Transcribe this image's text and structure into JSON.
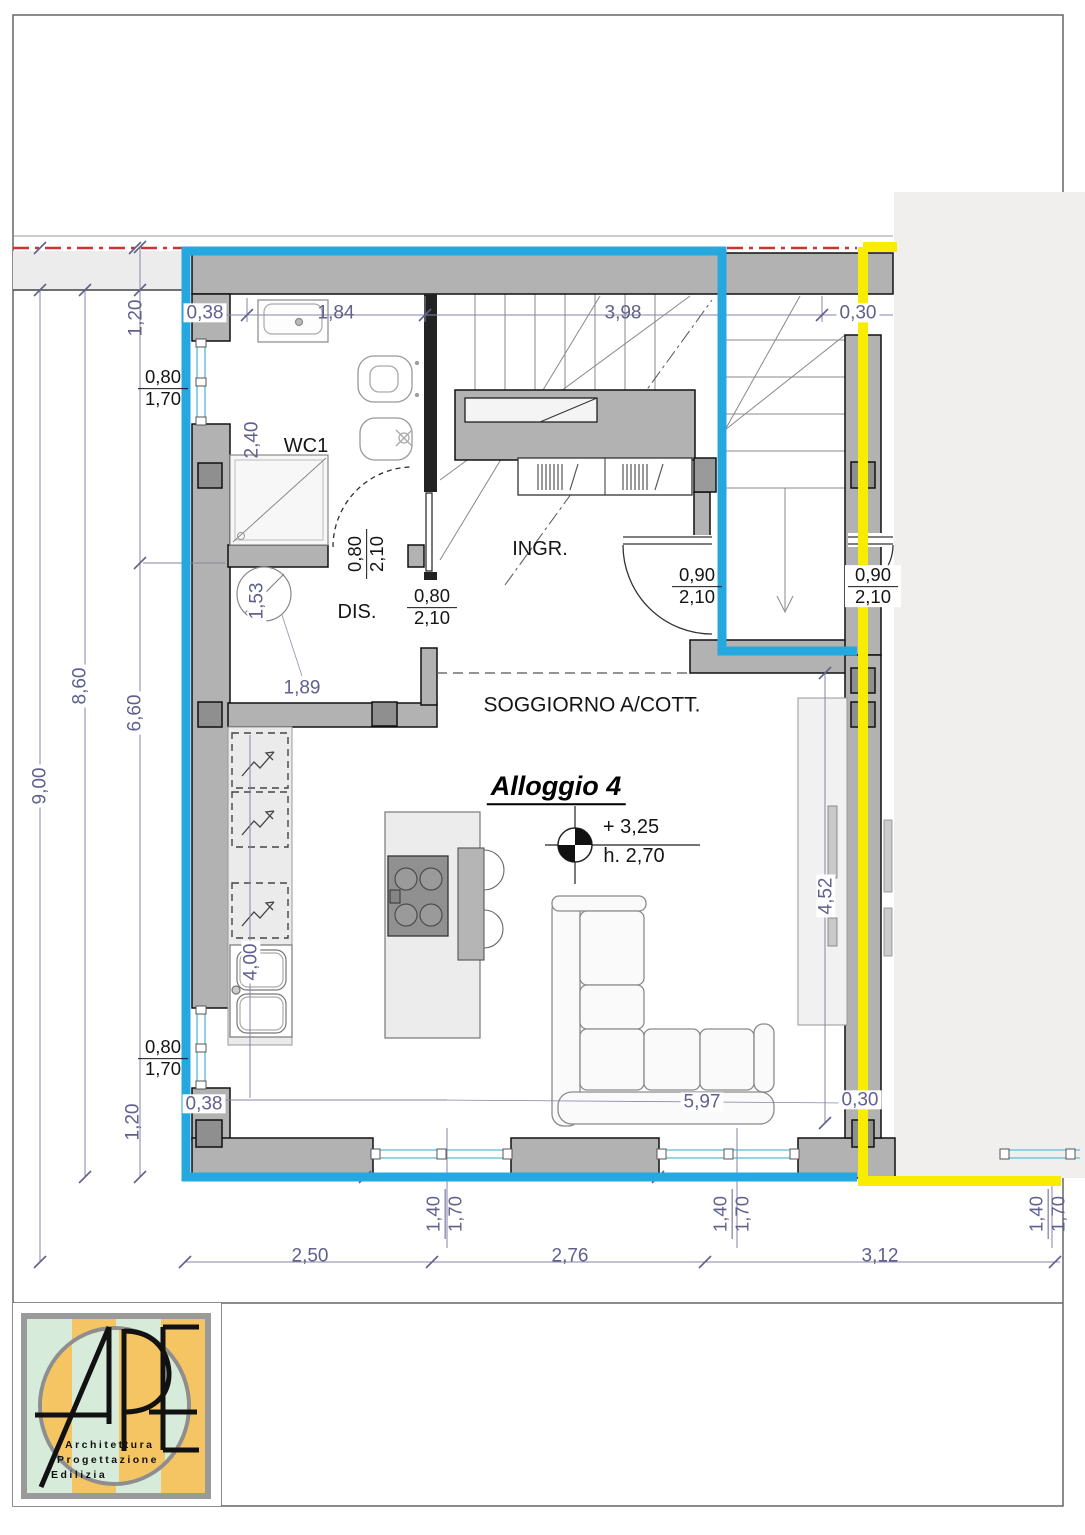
{
  "drawing": {
    "apartment_title": "Alloggio 4",
    "elevation_level": "+ 3,25",
    "elevation_height": "h. 2,70"
  },
  "colors": {
    "blue": "#25a8e0",
    "yellow": "#f8ec00",
    "red": "#cc3333",
    "wall": "#b2b2b2",
    "panel": "#f0efee",
    "strip": "#ececec",
    "counter": "#ebebeb",
    "dimColor": "#60608e",
    "window": "#74c6de",
    "logoGreen": "#d6ebd9",
    "logoOrange": "#f6c563"
  },
  "labels": [
    {
      "kind": "dim",
      "text": "0,38",
      "x": 205,
      "y": 313,
      "bg": 1
    },
    {
      "kind": "dim",
      "text": "1,84",
      "x": 336,
      "y": 313
    },
    {
      "kind": "dim",
      "text": "3,98",
      "x": 623,
      "y": 313
    },
    {
      "kind": "dim",
      "text": "0,30",
      "x": 858,
      "y": 313,
      "bg": 1
    },
    {
      "kind": "dim",
      "text": "1,20",
      "x": 136,
      "y": 318,
      "rot": -90
    },
    {
      "kind": "dim",
      "text": "2,40",
      "x": 252,
      "y": 440,
      "rot": -90
    },
    {
      "kind": "dim",
      "text": "1,53",
      "x": 257,
      "y": 601,
      "rot": -90,
      "bg": 1
    },
    {
      "kind": "dim",
      "text": "1,89",
      "x": 302,
      "y": 688,
      "bg": 1
    },
    {
      "kind": "dim",
      "text": "6,60",
      "x": 135,
      "y": 713,
      "rot": -90,
      "bg": 1
    },
    {
      "kind": "dim",
      "text": "8,60",
      "x": 80,
      "y": 686,
      "rot": -90,
      "bg": 1
    },
    {
      "kind": "dim",
      "text": "9,00",
      "x": 40,
      "y": 786,
      "rot": -90,
      "bg": 1
    },
    {
      "kind": "dim",
      "text": "4,00",
      "x": 251,
      "y": 962,
      "rot": -90,
      "bg": 1
    },
    {
      "kind": "dim",
      "text": "1,20",
      "x": 133,
      "y": 1122,
      "rot": -90
    },
    {
      "kind": "dim",
      "text": "0,38",
      "x": 204,
      "y": 1104,
      "bg": 1
    },
    {
      "kind": "dim",
      "text": "5,97",
      "x": 702,
      "y": 1102,
      "bg": 1
    },
    {
      "kind": "dim",
      "text": "0,30",
      "x": 860,
      "y": 1100,
      "bg": 1
    },
    {
      "kind": "dim",
      "text": "4,52",
      "x": 826,
      "y": 896,
      "rot": -90,
      "bg": 1
    },
    {
      "kind": "dim",
      "text": "2,50",
      "x": 310,
      "y": 1256
    },
    {
      "kind": "dim",
      "text": "2,76",
      "x": 570,
      "y": 1256
    },
    {
      "kind": "dim",
      "text": "3,12",
      "x": 880,
      "y": 1256
    },
    {
      "kind": "room",
      "text": "WC1",
      "x": 306,
      "y": 446,
      "name": "room-label-wc1"
    },
    {
      "kind": "room",
      "text": "DIS.",
      "x": 357,
      "y": 612,
      "name": "room-label-dis"
    },
    {
      "kind": "room",
      "text": "INGR.",
      "x": 540,
      "y": 549,
      "name": "room-label-ingresso"
    },
    {
      "kind": "room",
      "text": "SOGGIORNO A/COTT.",
      "x": 592,
      "y": 705,
      "size": 21,
      "name": "room-label-soggiorno"
    },
    {
      "kind": "room",
      "text": "+ 3,25",
      "x": 631,
      "y": 827,
      "name": "elevation-level"
    },
    {
      "kind": "room",
      "text": "h. 2,70",
      "x": 634,
      "y": 856,
      "name": "elevation-height"
    },
    {
      "kind": "title",
      "text": "Alloggio 4",
      "x": 556,
      "y": 789,
      "name": "apartment-title"
    },
    {
      "kind": "frac",
      "top": "0,80",
      "bot": "1,70",
      "x": 163,
      "y": 388,
      "color": "room"
    },
    {
      "kind": "frac",
      "top": "0,80",
      "bot": "1,70",
      "x": 163,
      "y": 1058,
      "color": "room"
    },
    {
      "kind": "frac",
      "top": "0,80",
      "bot": "2,10",
      "x": 366,
      "y": 554,
      "rot": -90,
      "color": "room"
    },
    {
      "kind": "frac",
      "top": "0,80",
      "bot": "2,10",
      "x": 432,
      "y": 607,
      "color": "room"
    },
    {
      "kind": "frac",
      "top": "0,90",
      "bot": "2,10",
      "x": 697,
      "y": 586,
      "color": "room"
    },
    {
      "kind": "frac",
      "top": "0,90",
      "bot": "2,10",
      "x": 873,
      "y": 586,
      "color": "room",
      "bg": 1
    },
    {
      "kind": "frac",
      "top": "1,40",
      "bot": "1,70",
      "x": 445,
      "y": 1214,
      "rot": -90,
      "color": "dim"
    },
    {
      "kind": "frac",
      "top": "1,40",
      "bot": "1,70",
      "x": 732,
      "y": 1214,
      "rot": -90,
      "color": "dim"
    },
    {
      "kind": "frac",
      "top": "1,40",
      "bot": "1,70",
      "x": 1048,
      "y": 1214,
      "rot": -90,
      "color": "dim"
    }
  ],
  "logo": {
    "letters": "APE",
    "line1": "Architettura",
    "line2": "Progettazione",
    "line3": "Edilizia"
  }
}
